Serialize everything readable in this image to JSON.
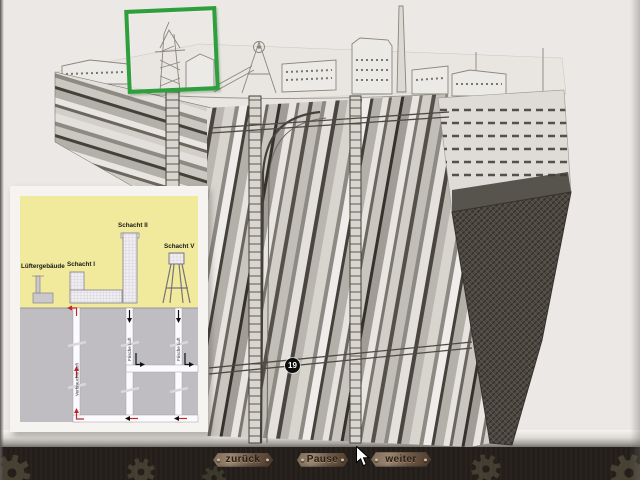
{
  "screen": {
    "background": "#ebe8e5"
  },
  "highlight": {
    "color": "#2f9e3c"
  },
  "engraving": {
    "marker_label": "19"
  },
  "inset": {
    "labels": {
      "fan_building": "Lüftergebäude",
      "shaft1": "Schacht I",
      "shaft2": "Schacht II",
      "shaft5": "Schacht V",
      "air_left": "Verbrauchte Luft",
      "air_middle": "Frische Luft",
      "air_right": "Frische Luft"
    },
    "colors": {
      "sky": "#f1ea9c",
      "ground": "#bfbcc2",
      "tunnel": "#fbfafd",
      "arrow_red": "#c1272d",
      "arrow_black": "#111111"
    }
  },
  "navbar": {
    "buttons": [
      {
        "id": "back",
        "label": "zurück"
      },
      {
        "id": "pause",
        "label": "Pause"
      },
      {
        "id": "next",
        "label": "weiter"
      }
    ]
  }
}
